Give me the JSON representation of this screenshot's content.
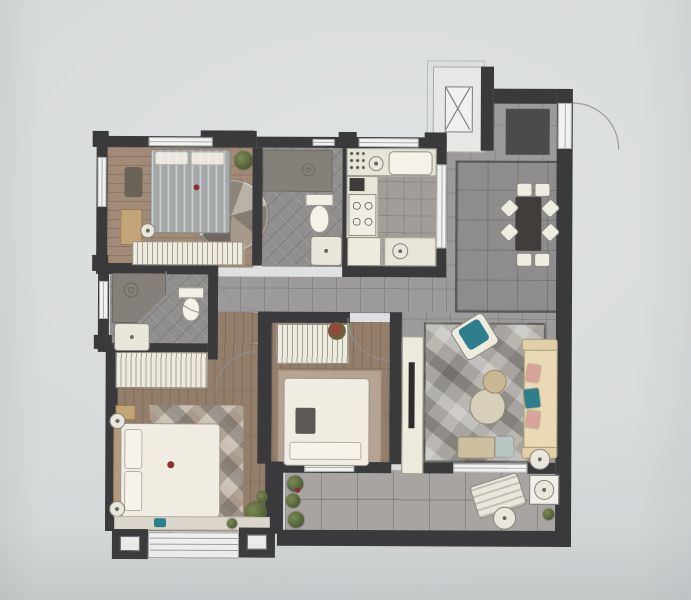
{
  "colors": {
    "background": "#d7dadb",
    "background_edge": "#cfd3d4",
    "wall": "#3a393b",
    "tile": "#9d9a9b",
    "tile_dark": "#8f8c8d",
    "balcony_tile": "#a7a4a1",
    "bath_tile": "#918f8e",
    "kitchen_floor": "#a39d98",
    "wood": "#a18a77",
    "wood_dark": "#937d6b",
    "furniture_white": "#edeade",
    "counter_white": "#e7e4d8",
    "duvet": "#a3a7a8",
    "bed_white": "#f0ece1",
    "rug_living": "#a8a5a0",
    "rug_master": "#b0a494",
    "rug_bed3": "#b5a492",
    "shower": "#85817a",
    "sofa_cream": "#e9d9b5",
    "teal": "#2f7e8e",
    "pink": "#d8a39a",
    "plant_green": "#66743f",
    "red_flower": "#8e2f2f",
    "table_dark": "#413d3b",
    "wood_cabinet": "#c2a477",
    "mat_dark": "#4b4b4d",
    "sill_light": "#dbd6cc",
    "line_faint": "#8d9294",
    "glass": "#f2f3f1",
    "tv_dark": "#2e2c2b"
  },
  "floorplan": {
    "type": "apartment-floor-plan-rendering",
    "rooms": [
      {
        "id": "bedroom-top-left",
        "kind": "bedroom",
        "floor": "wood",
        "furniture": [
          "bed-gray-striped",
          "round-patchwork-rug",
          "wardrobe",
          "dresser",
          "stool",
          "plant"
        ]
      },
      {
        "id": "bathroom-top",
        "kind": "bathroom",
        "floor": "tile",
        "furniture": [
          "shower",
          "toilet",
          "vanity-sink"
        ]
      },
      {
        "id": "kitchen",
        "kind": "kitchen",
        "floor": "tile",
        "furniture": [
          "counter",
          "sink",
          "kettle",
          "coffee-machine",
          "stove-4-burner",
          "fridge"
        ]
      },
      {
        "id": "entry-foyer",
        "kind": "entry",
        "floor": "tile",
        "furniture": [
          "doormat",
          "entry-door-swing"
        ]
      },
      {
        "id": "dining-area",
        "kind": "dining",
        "floor": "tile",
        "furniture": [
          "dining-table",
          "chairs"
        ],
        "chair_count": 8
      },
      {
        "id": "master-bathroom",
        "kind": "bathroom",
        "floor": "tile",
        "furniture": [
          "corner-shower",
          "toilet",
          "vanity-sink"
        ]
      },
      {
        "id": "walk-in-closet",
        "kind": "closet",
        "floor": "wood",
        "furniture": [
          "wardrobe"
        ]
      },
      {
        "id": "master-bedroom",
        "kind": "bedroom",
        "floor": "wood",
        "furniture": [
          "double-bed",
          "argyle-rug",
          "nightstand",
          "nightstand",
          "plant",
          "bay-window",
          "wall-sconce",
          "wall-sconce"
        ]
      },
      {
        "id": "bedroom-center",
        "kind": "bedroom",
        "floor": "wood",
        "furniture": [
          "bed",
          "wardrobe-with-flowers",
          "rug",
          "south-window"
        ]
      },
      {
        "id": "living-room",
        "kind": "living",
        "floor": "tile",
        "furniture": [
          "sofa-with-pillows",
          "accent-armchair",
          "coffee-table-large",
          "coffee-table-small",
          "tv-console",
          "wall-tv",
          "floor-lamp",
          "bench",
          "ottoman",
          "patchwork-rug"
        ]
      },
      {
        "id": "balcony",
        "kind": "balcony",
        "floor": "tile",
        "furniture": [
          "lounge-chair",
          "round-side-table",
          "washing-machine",
          "plants"
        ]
      },
      {
        "id": "elevator-lobby",
        "kind": "common-area",
        "floor": "none",
        "furniture": [
          "elevator-shaft-x-symbol"
        ]
      }
    ]
  }
}
